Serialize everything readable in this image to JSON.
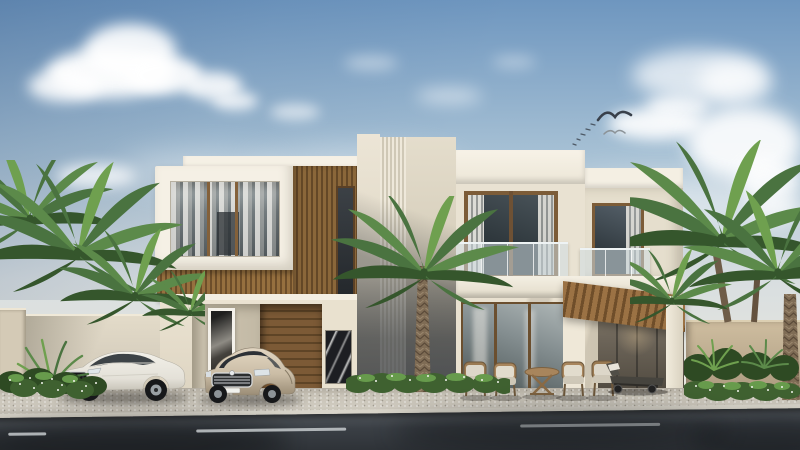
{
  "scene": {
    "type": "architectural exterior rendering",
    "description": "Photorealistic daytime 3D visualization of a modern two-story cream stone villa with vertical wood-slat accents, a fluted stone tower, glass balustrade balconies, a wood pergola, palm trees, flowering hedges, two parked luxury sedans and an asphalt street in the foreground under a partly cloudy blue sky with birds.",
    "time_of_day": "day",
    "sky": {
      "condition": "partly cloudy",
      "birds_count": 7
    },
    "building": {
      "style": "modern minimalist villa",
      "stories": 2,
      "materials": [
        "cream stone",
        "white trim",
        "vertical wood slats",
        "fluted stone",
        "glass",
        "dark marble accent"
      ],
      "features": [
        "recessed picture window",
        "glass balcony railings",
        "wood garage door",
        "framed abstract artwork",
        "marble accent panel",
        "wood pergola",
        "sliding glass doors"
      ]
    },
    "vehicles": [
      {
        "type": "sedan",
        "color": "white",
        "view": "three-quarter front-left"
      },
      {
        "type": "sedan",
        "color": "champagne silver",
        "view": "front"
      }
    ],
    "landscape": {
      "palm_trees": 8,
      "hedges": "green with small white flowers",
      "perimeter_walls": 2
    },
    "street": {
      "surface": "dark asphalt",
      "lane_marking": "dashed white center line",
      "dashes_visible": 3,
      "sidewalk": "light speckled concrete with curb"
    },
    "outdoor_furniture": {
      "armchairs": 4,
      "coffee_table": 1,
      "sun_lounger": 1
    }
  },
  "palette": {
    "sky_top": "#6e96bf",
    "sky_mid": "#a6c0d4",
    "sky_low": "#d8dee0",
    "sky_horizon": "#e9e7dd",
    "cloud": "#ffffff",
    "bird_dark": "#39404a",
    "bird_light": "#8c9398",
    "facade": "#e9e2d2",
    "facade_bright": "#f6f1e6",
    "facade_shadow": "#cfc6b3",
    "trim_white": "#f5f0e5",
    "wood": "#96703f",
    "wood_dark": "#6d4e2a",
    "wood_light": "#b08a5c",
    "glass_dark": "#343e44",
    "glass_mid": "#5d686e",
    "glass_light": "#9aa4a8",
    "curtain": "#edebe4",
    "railing_glass": "#cfdde2",
    "tower_dark": "#5f6266",
    "wall_left": "#d9d1c0",
    "wall_right": "#bfae92",
    "hedge_dark": "#2e4a23",
    "hedge": "#3f6130",
    "hedge_light": "#679b4c",
    "palm_dark": "#35562c",
    "palm": "#4a7340",
    "palm_light": "#5c8a4a",
    "palm_pale": "#6fa04f",
    "trunk": "#7f6c55",
    "trunk_dark": "#5a4a39",
    "pavement": "#c2bcb0",
    "pavement_dark": "#aaa497",
    "curb": "#d9d5ca",
    "road": "#3a3f45",
    "road_dark": "#24282d",
    "marking": "#c6cacc",
    "car_white": "#f2f0e9",
    "car_white_shade": "#c9c5ba",
    "car_champagne": "#cbbda6",
    "car_champagne_shade": "#9b8d76",
    "art_frame": "#f4f1ea",
    "marble_dark": "#1d1e22",
    "shadow": "#3c382f"
  }
}
